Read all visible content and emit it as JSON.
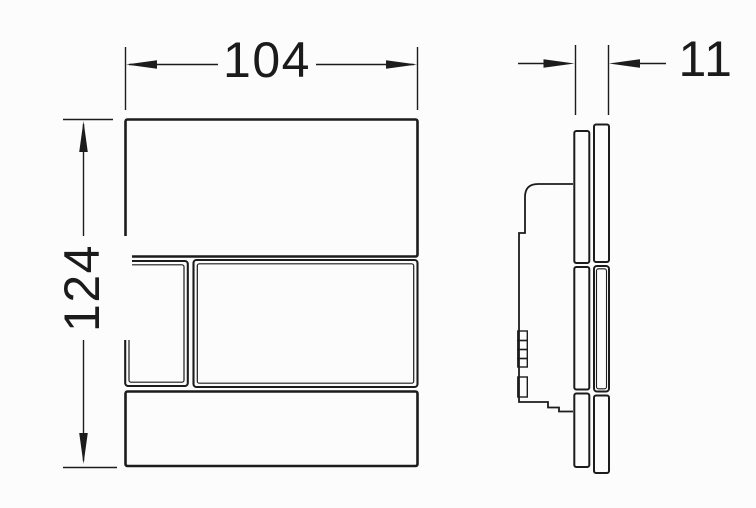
{
  "figure": {
    "background_color": "#fcfcfc",
    "line_color": "#1c1c1c"
  },
  "dimensions": {
    "width": {
      "value": "104"
    },
    "height": {
      "value": "124"
    },
    "depth": {
      "value": "11"
    }
  }
}
